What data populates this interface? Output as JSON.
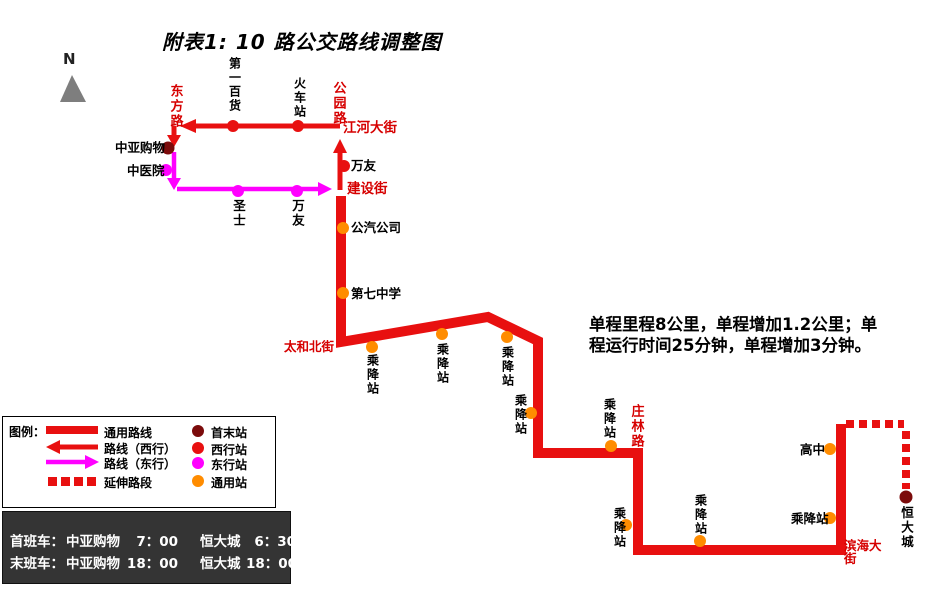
{
  "title": "附表1: 10 路公交路线调整图",
  "compass_label": "N",
  "note_lines": [
    "单程里程8公里，单程增加1.2公里；单",
    "程运行时间25分钟，单程增加3分钟。"
  ],
  "streets": {
    "dongfanglu": "东方路",
    "gongyuanlu": "公园路",
    "jianghedajie": "江河大街",
    "jianshejie": "建设街",
    "taihebeijie": "太和北街",
    "zhuanglinlu": "庄林路",
    "binhaidajie": "滨海大街"
  },
  "stations": {
    "terminal_west": "中亚购物",
    "zhongyiyuan": "中医院",
    "diyibaihuo": "第一百货",
    "huochezhan": "火车站",
    "wanyou": "万友",
    "shengshi": "圣士",
    "gongqigongsi": "公汽公司",
    "diqizhongxue": "第七中学",
    "chengjiangzhan": "乘降站",
    "gaozhong": "高中",
    "terminal_east": "恒大城"
  },
  "legend": {
    "title": "图例：",
    "lines": [
      {
        "label": "通用路线",
        "style": "solid-red"
      },
      {
        "label": "路线（西行）",
        "style": "arrow-left-red"
      },
      {
        "label": "路线（东行）",
        "style": "arrow-right-magenta"
      },
      {
        "label": "延伸路段",
        "style": "dashed-red"
      }
    ],
    "stations": [
      {
        "label": "首末站",
        "color": "#7b0b0b"
      },
      {
        "label": "西行站",
        "color": "#e81010"
      },
      {
        "label": "东行站",
        "color": "#ff00ff"
      },
      {
        "label": "通用站",
        "color": "#ff8c00"
      }
    ]
  },
  "schedule": {
    "rows": [
      {
        "service": "首班车：",
        "stop_a": "中亚购物",
        "time_a": "7：00",
        "stop_b": "恒大城",
        "time_b": "6：30"
      },
      {
        "service": "末班车：",
        "stop_a": "中亚购物",
        "time_a": "18：00",
        "stop_b": "恒大城",
        "time_b": "18：00"
      }
    ]
  },
  "colors": {
    "route": "#e81010",
    "eastbound": "#ff00ff",
    "terminal": "#7b0b0b",
    "west_station": "#e81010",
    "common_station": "#ff8c00",
    "street_label": "#d60000",
    "north_arrow": "#7e7e7e",
    "schedule_bg": "#343434"
  }
}
